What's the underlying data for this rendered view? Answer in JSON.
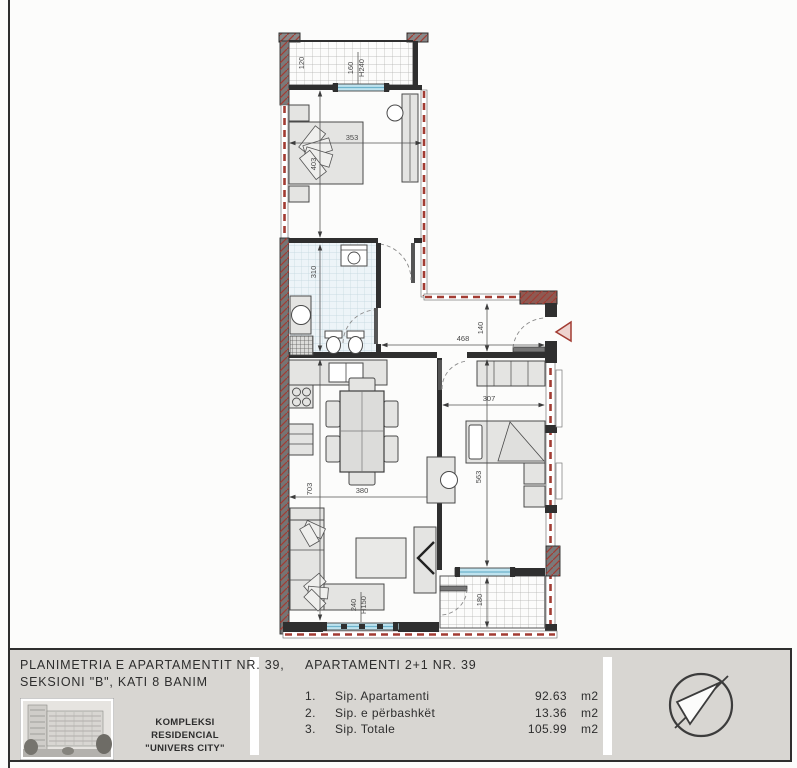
{
  "colors": {
    "wall": "#2f2f2f",
    "boundary-red": "#a23c33",
    "window-glass": "#bfe3ef",
    "furniture-fill": "#e4e4e2",
    "titleblock-bg": "#d8d6d2"
  },
  "plan": {
    "dims": {
      "balcony1_w": "120",
      "win1_w": "160",
      "win1_h": "H240",
      "bed1_w": "353",
      "bed1_h": "403",
      "bath_h": "310",
      "hall_w": "468",
      "hall_h": "140",
      "bed2_w": "307",
      "bed2_h": "563",
      "living_w": "380",
      "living_h": "703",
      "win2_w": "240",
      "win2_h": "H150",
      "balcony2_h": "180"
    }
  },
  "titleblock": {
    "title_line1": "PLANIMETRIA E APARTAMENTIT NR. 39,",
    "title_line2": "SEKSIONI \"B\", KATI 8 BANIM",
    "complex_line1": "KOMPLEKSI RESIDENCIAL",
    "complex_line2": "\"UNIVERS CITY\"",
    "apartment_header": "APARTAMENTI 2+1 NR. 39",
    "areas": [
      {
        "no": "1.",
        "label": "Sip. Apartamenti",
        "value": "92.63",
        "unit": "m2"
      },
      {
        "no": "2.",
        "label": "Sip. e përbashkët",
        "value": "13.36",
        "unit": "m2"
      },
      {
        "no": "3.",
        "label": "Sip. Totale",
        "value": "105.99",
        "unit": "m2"
      }
    ],
    "north_icon": "north-arrow"
  }
}
